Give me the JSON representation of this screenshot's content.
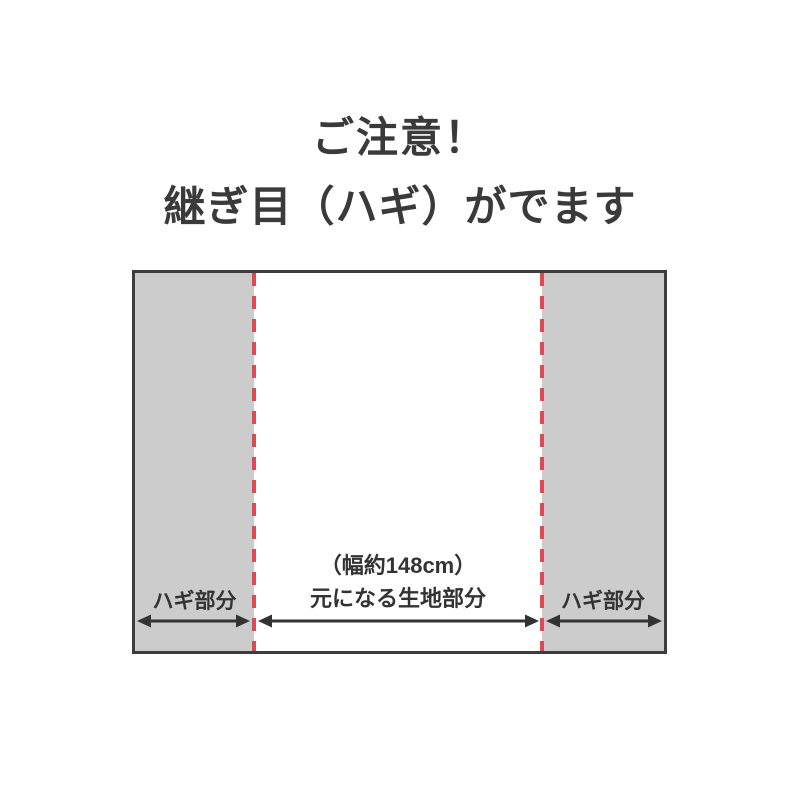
{
  "title": {
    "line1": "ご注意！",
    "line2": "継ぎ目（ハギ）がでます"
  },
  "diagram": {
    "left_section": {
      "label": "ハギ部分"
    },
    "center_section": {
      "width_note": "（幅約148cm）",
      "label": "元になる生地部分"
    },
    "right_section": {
      "label": "ハギ部分"
    }
  },
  "colors": {
    "text": "#3a3a3a",
    "label_text": "#333333",
    "border": "#3d3d3d",
    "gray_fill": "#cccccc",
    "seam_red": "#dc4b54",
    "arrow": "#333333",
    "background": "#ffffff"
  }
}
